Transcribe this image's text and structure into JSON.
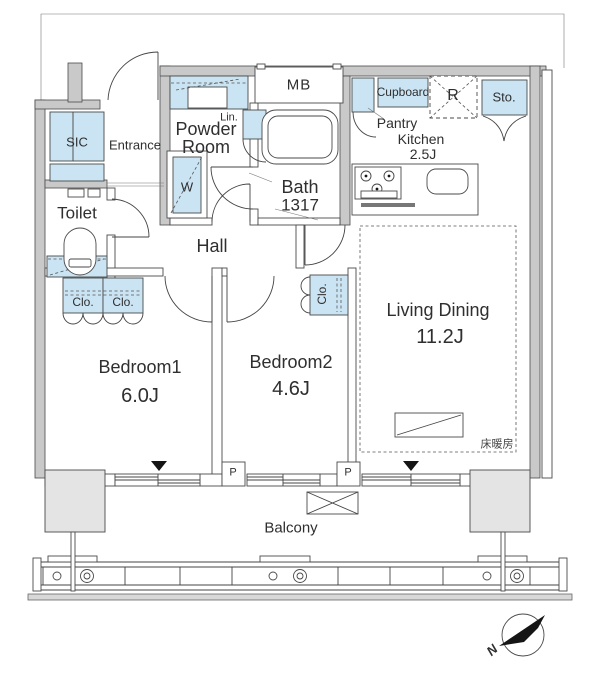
{
  "colors": {
    "fixture_blue": "#cbe4f3",
    "wall_gray": "#c9c9c9",
    "pillar_gray": "#e4e4e4",
    "line_dark": "#4a4a4a"
  },
  "rooms": {
    "sic": {
      "label": "SIC"
    },
    "entrance": {
      "label": "Entrance"
    },
    "toilet": {
      "label": "Toilet"
    },
    "powder_room": {
      "label_line1": "Powder",
      "label_line2": "Room"
    },
    "linen": {
      "label": "Lin."
    },
    "washer": {
      "label": "W"
    },
    "meter_box": {
      "label": "MB"
    },
    "bath": {
      "label": "Bath",
      "size": "1317"
    },
    "pantry_kitchen": {
      "line1": "Pantry",
      "line2": "Kitchen",
      "size": "2.5J"
    },
    "cupboard": {
      "label": "Cupboard"
    },
    "refrigerator": {
      "label": "R"
    },
    "storage": {
      "label": "Sto."
    },
    "hall": {
      "label": "Hall"
    },
    "bedroom1": {
      "label": "Bedroom1",
      "size": "6.0J",
      "closet_left": "Clo.",
      "closet_right": "Clo."
    },
    "bedroom2": {
      "label": "Bedroom2",
      "size": "4.6J",
      "closet": "Clo."
    },
    "living_dining": {
      "label": "Living Dining",
      "size": "11.2J",
      "floor_heating": "床暖房"
    },
    "balcony": {
      "label": "Balcony",
      "pipe1": "P",
      "pipe2": "P"
    }
  },
  "compass": {
    "north": "N"
  }
}
